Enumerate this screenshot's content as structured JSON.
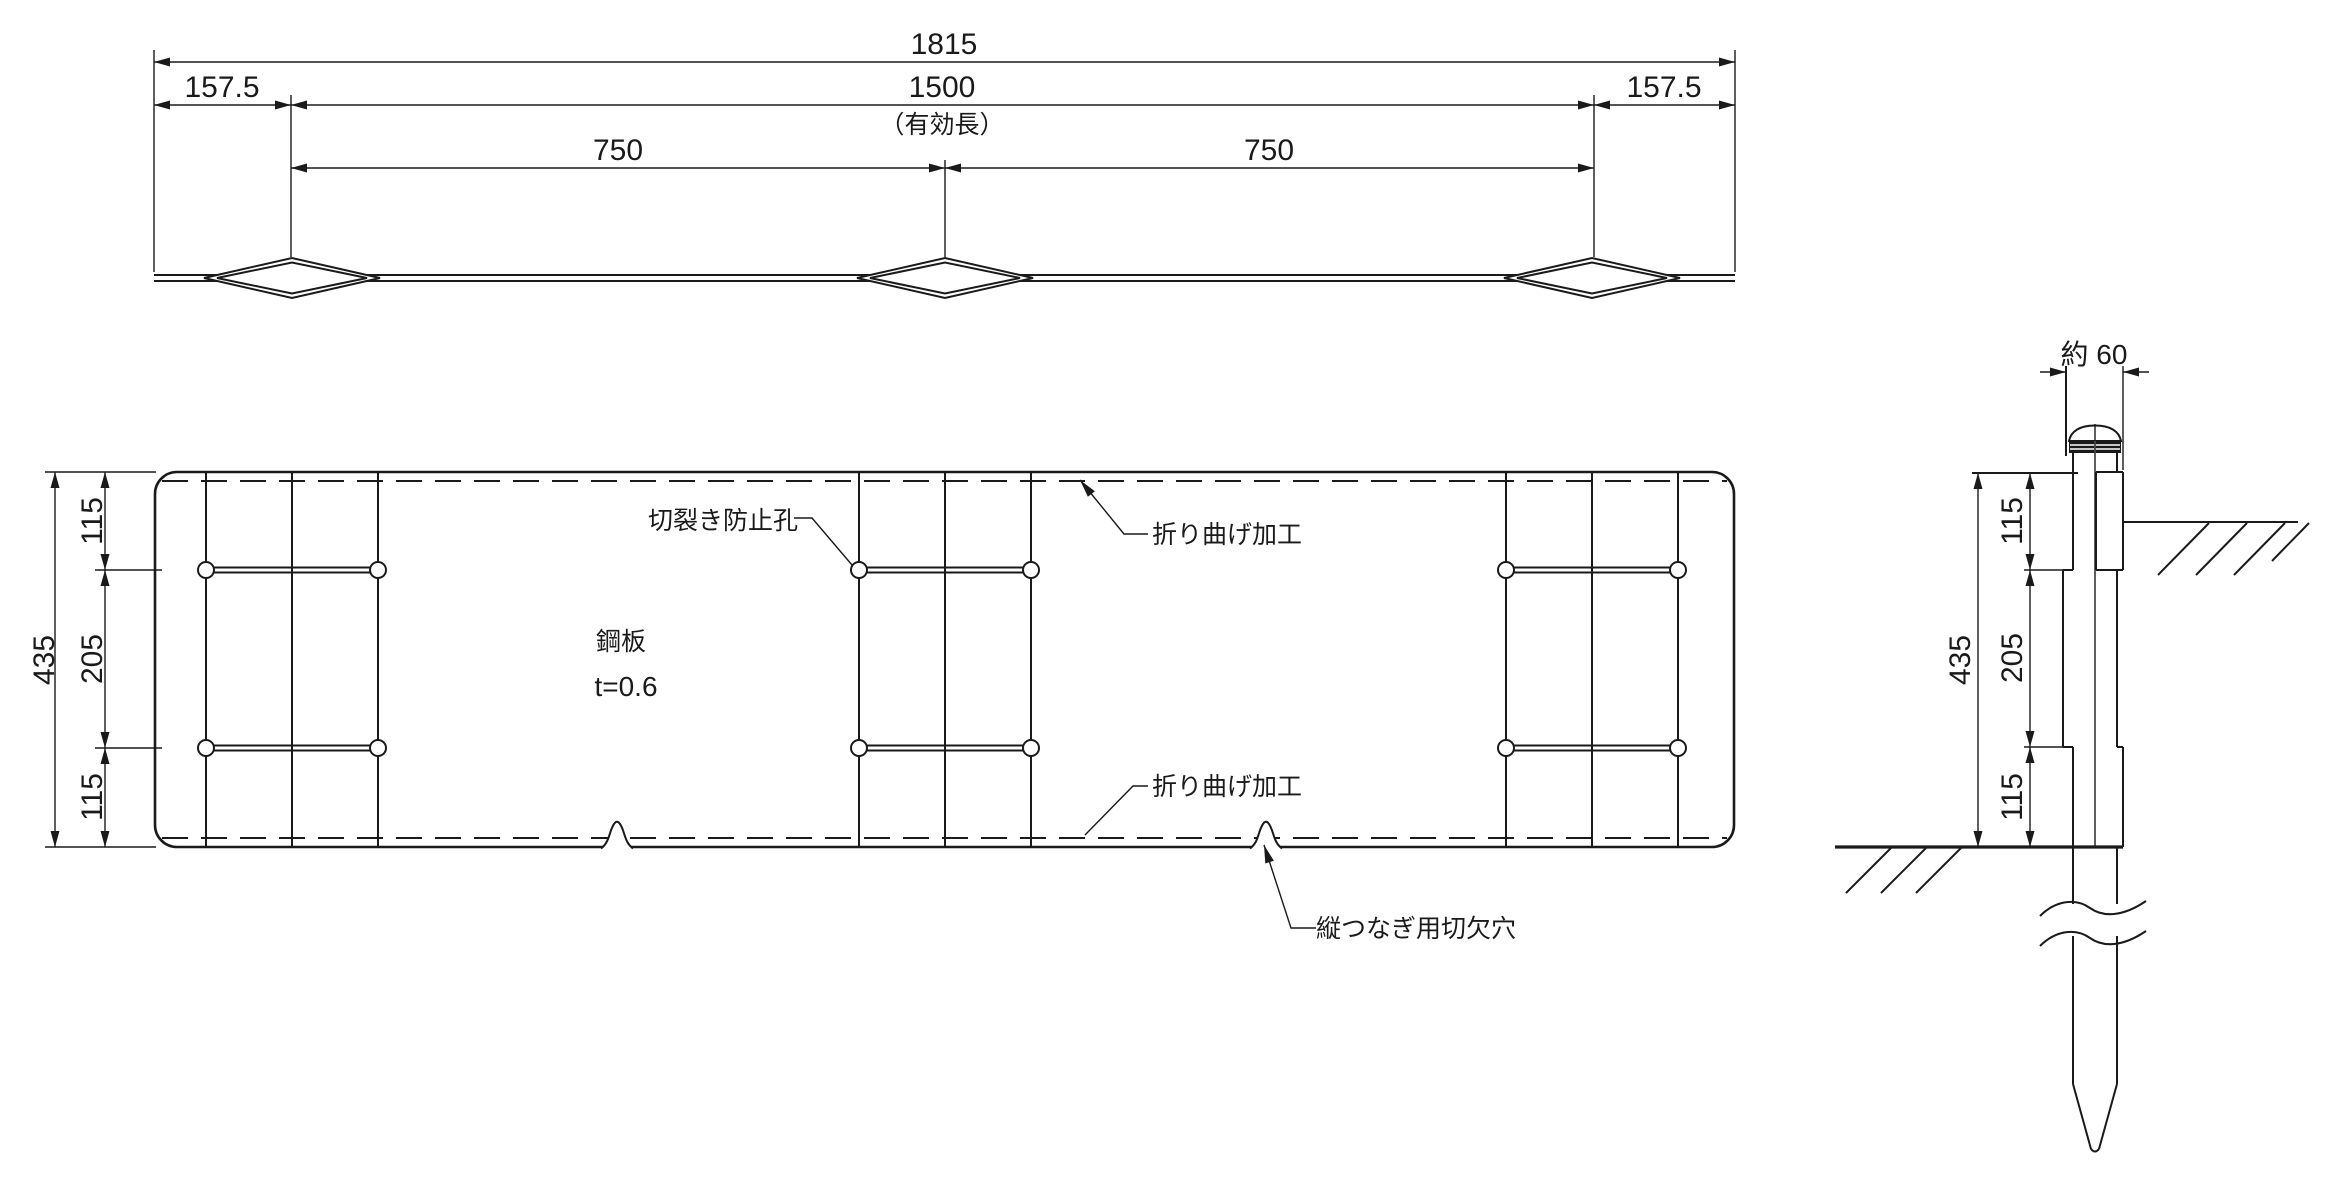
{
  "drawing": {
    "colors": {
      "line": "#1a1a1a",
      "background": "#ffffff"
    },
    "top_view": {
      "dim_overall": "1815",
      "dim_left_margin": "157.5",
      "dim_effective": "1500",
      "dim_effective_note": "（有効長）",
      "dim_right_margin": "157.5",
      "dim_half_left": "750",
      "dim_half_right": "750"
    },
    "plan_view": {
      "dim_total_height": "435",
      "dim_top_section": "115",
      "dim_middle_section": "205",
      "dim_bottom_section": "115",
      "label_tear_hole": "切裂き防止孔",
      "label_material": "鋼板",
      "label_thickness": "t=0.6",
      "label_fold_top": "折り曲げ加工",
      "label_fold_bottom": "折り曲げ加工",
      "label_notch": "縦つなぎ用切欠穴"
    },
    "side_view": {
      "dim_width": "約 60",
      "dim_total_height": "435",
      "dim_top_section": "115",
      "dim_middle_section": "205",
      "dim_bottom_section": "115"
    }
  }
}
